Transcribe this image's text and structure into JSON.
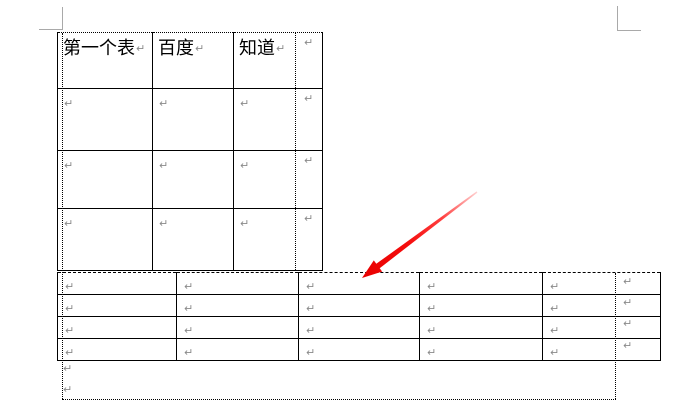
{
  "app": {
    "type": "word-document-page-view"
  },
  "marks": {
    "pilcrow": "↵"
  },
  "colors": {
    "page_background": "#ffffff",
    "table_border": "#000000",
    "text_boundary": "#000000",
    "crop_mark": "#a9a9a9",
    "pilcrow": "#8a8a8a",
    "arrow_tail": "#ffd0d0",
    "arrow_mid": "#ff4040",
    "arrow_head": "#e80000"
  },
  "table1": {
    "name": "first-table",
    "headers": [
      "第一个表",
      "百度",
      "知道"
    ],
    "rows": 4,
    "cols": 3
  },
  "table2": {
    "name": "second-table",
    "rows": 4,
    "cols": 5
  },
  "below_paragraphs": {
    "count": 2
  }
}
